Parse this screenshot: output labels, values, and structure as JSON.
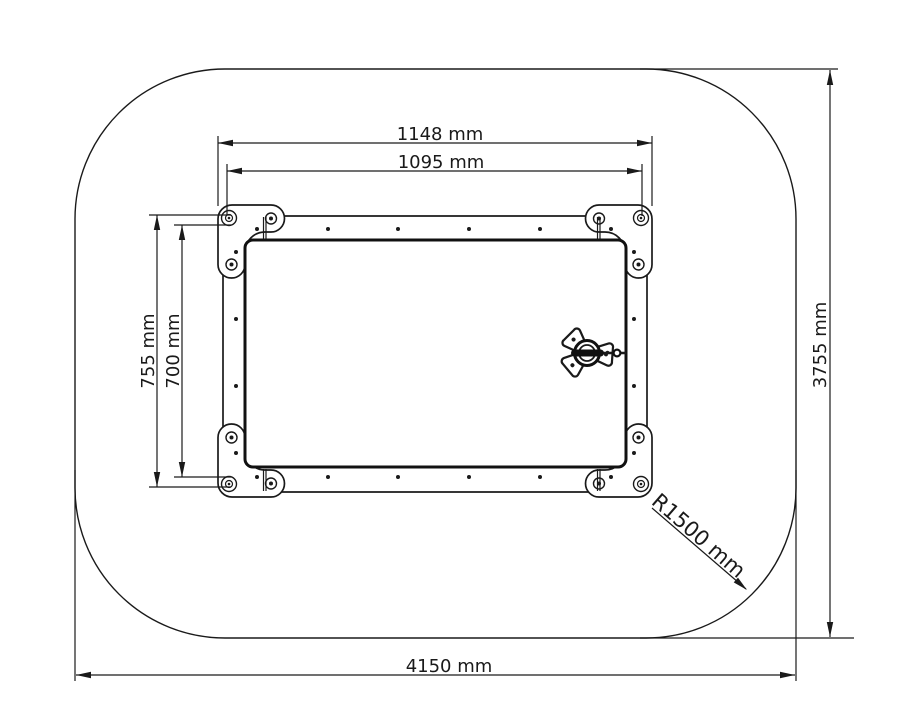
{
  "drawing": {
    "type": "technical-top-view",
    "colors": {
      "ink": "#1a1a1a",
      "background": "#ffffff"
    },
    "labels": {
      "frame_width": "1148 mm",
      "inner_width": "1095 mm",
      "frame_height": "755 mm",
      "inner_height": "700 mm",
      "safety_zone_length": "4150 mm",
      "safety_zone_height": "3755 mm",
      "corner_radius": "R1500 mm"
    }
  }
}
